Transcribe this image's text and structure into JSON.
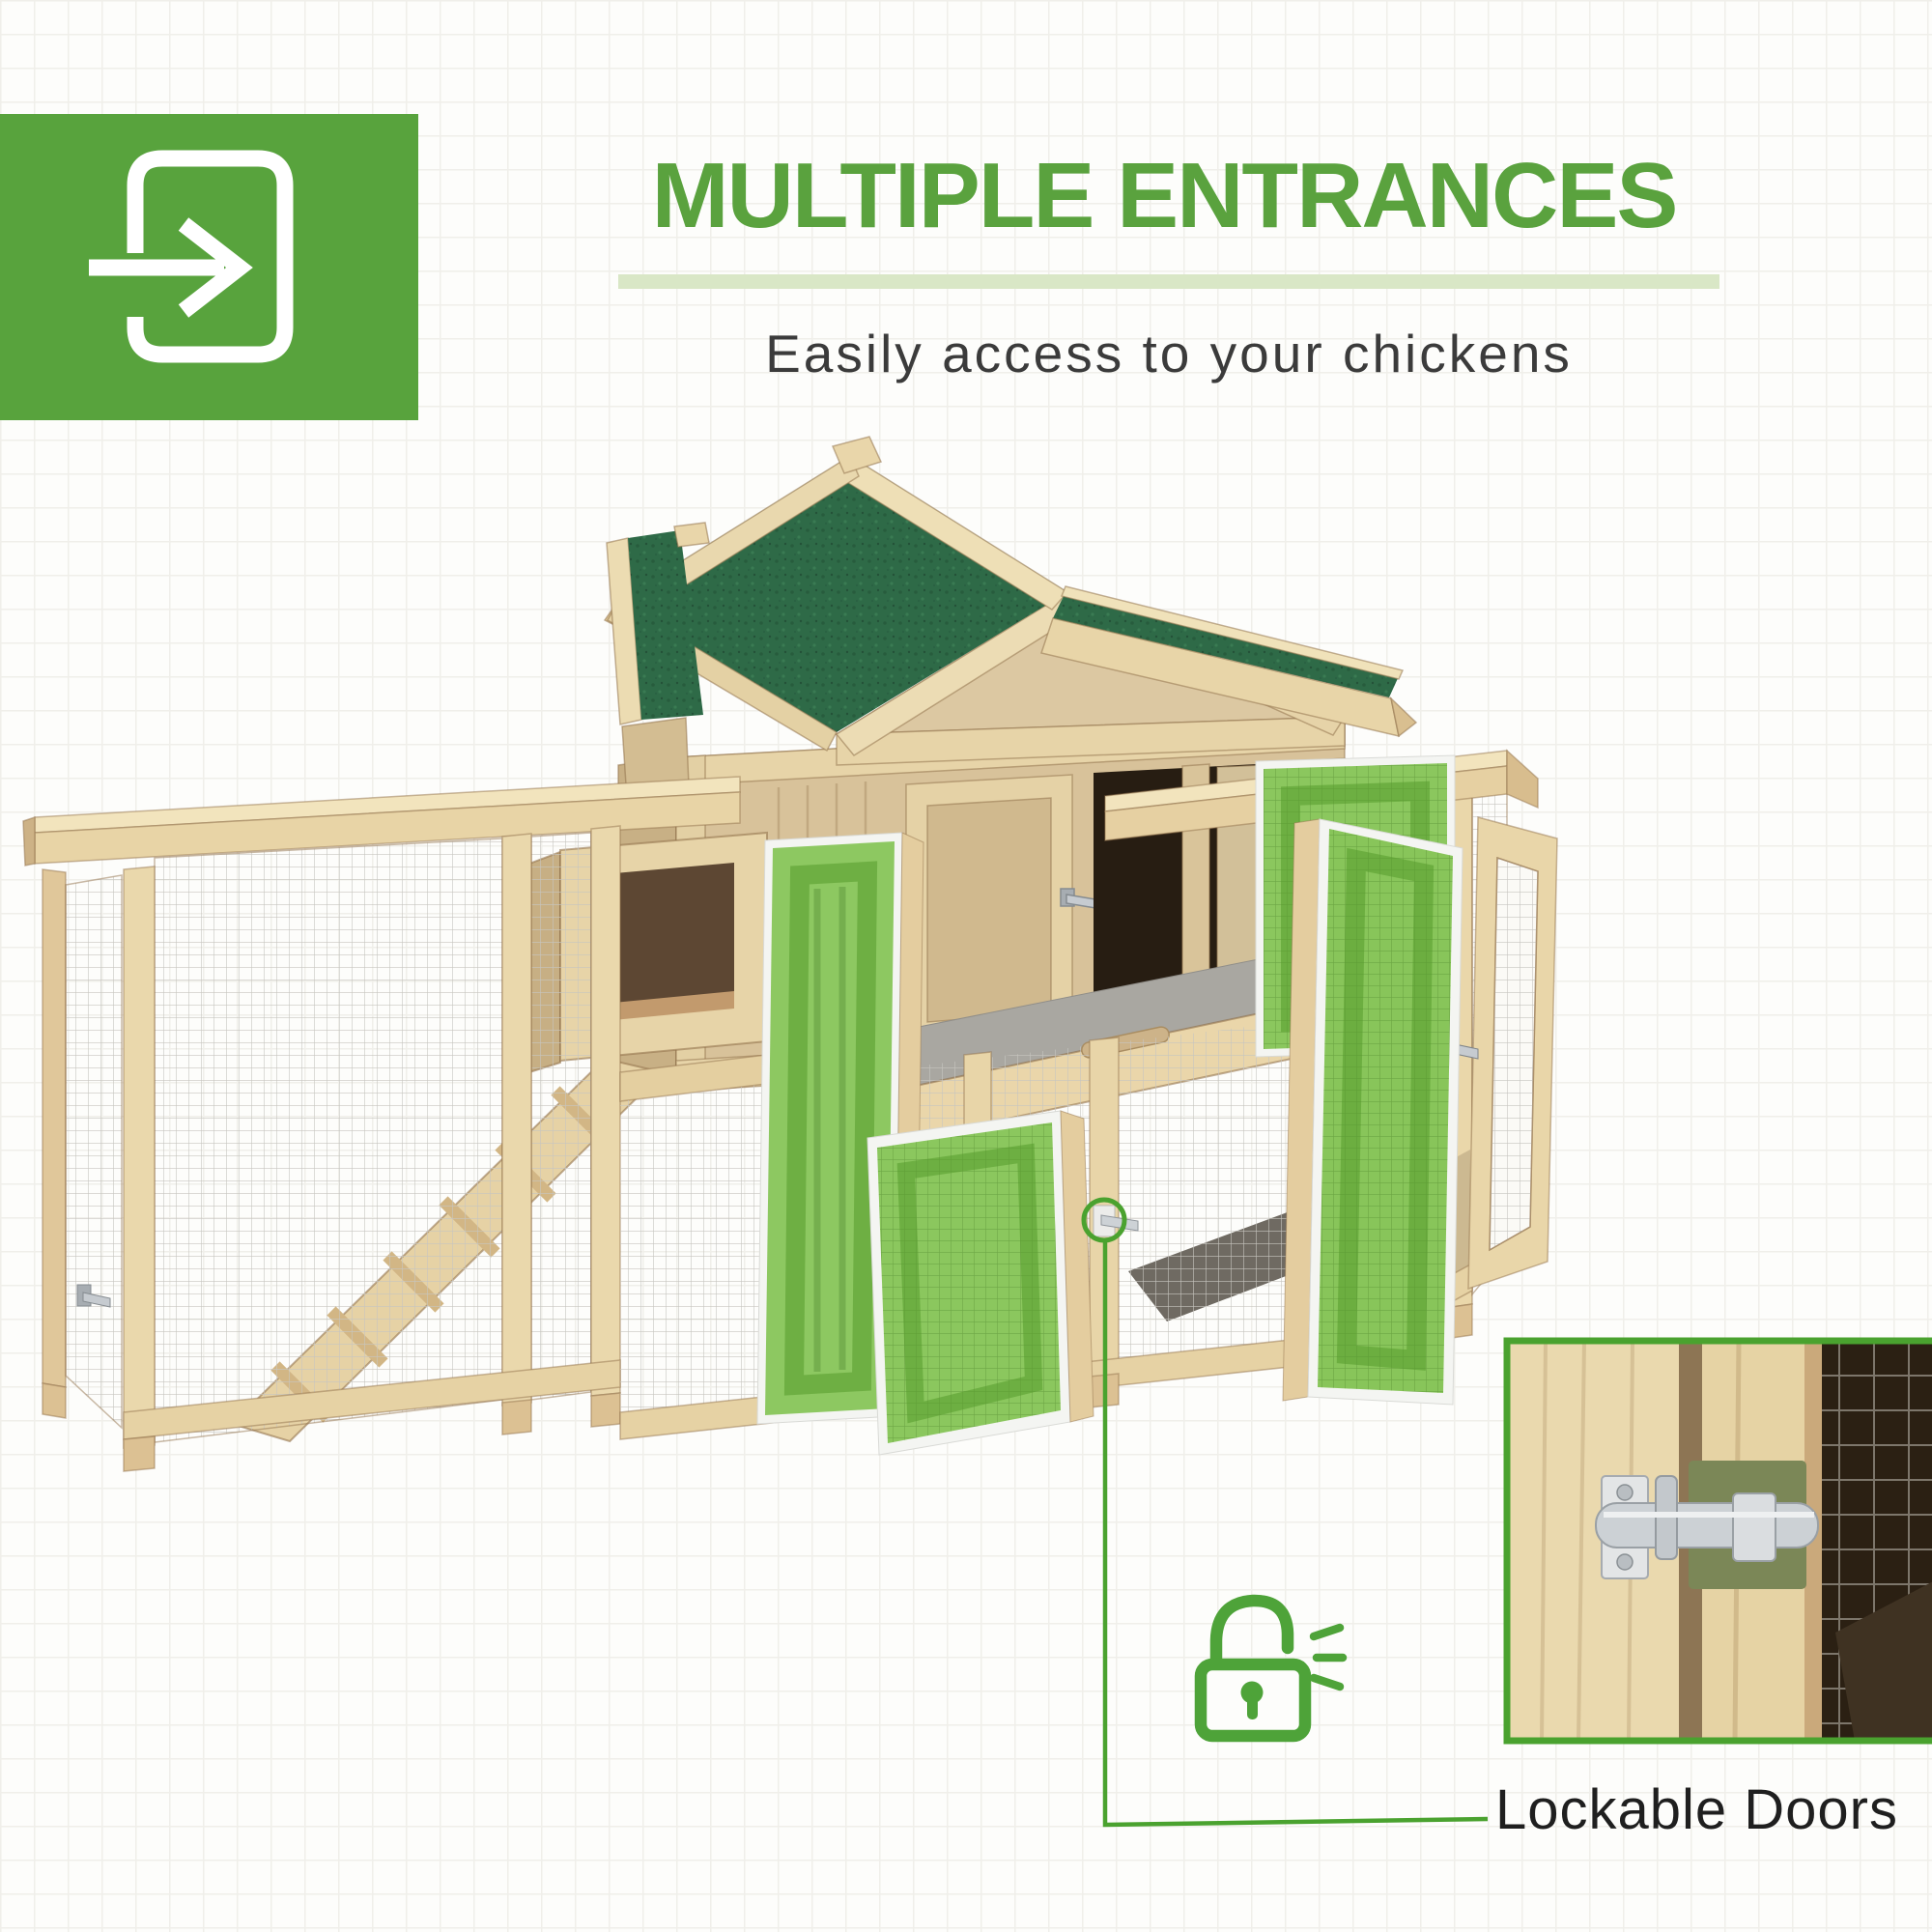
{
  "page": {
    "type": "product-feature-graphic"
  },
  "header": {
    "title": "MULTIPLE ENTRANCES",
    "subtitle": "Easily access to your chickens",
    "badge_icon": "enter-arrow-icon"
  },
  "callout": {
    "label": "Lockable Doors",
    "icon": "open-padlock-icon"
  },
  "illustration": {
    "subject": "wooden chicken coop with green asphalt roof, wire mesh runs on both sides, ladder ramp, pull-out tray and highlighted green doors",
    "highlighted_door_panels": 4,
    "inset": "close-up photo of metal slide-bolt door latch"
  },
  "colors": {
    "accent_green": "#58a33d",
    "title_green": "#5aa23e",
    "underline_green": "#d9e7c6",
    "highlight_door_green": "#7cc04a",
    "callout_green": "#4aa22f",
    "roof_green": "#2e6a47",
    "wood_light": "#e9d7ac",
    "text_dark": "#3b3b3b"
  }
}
